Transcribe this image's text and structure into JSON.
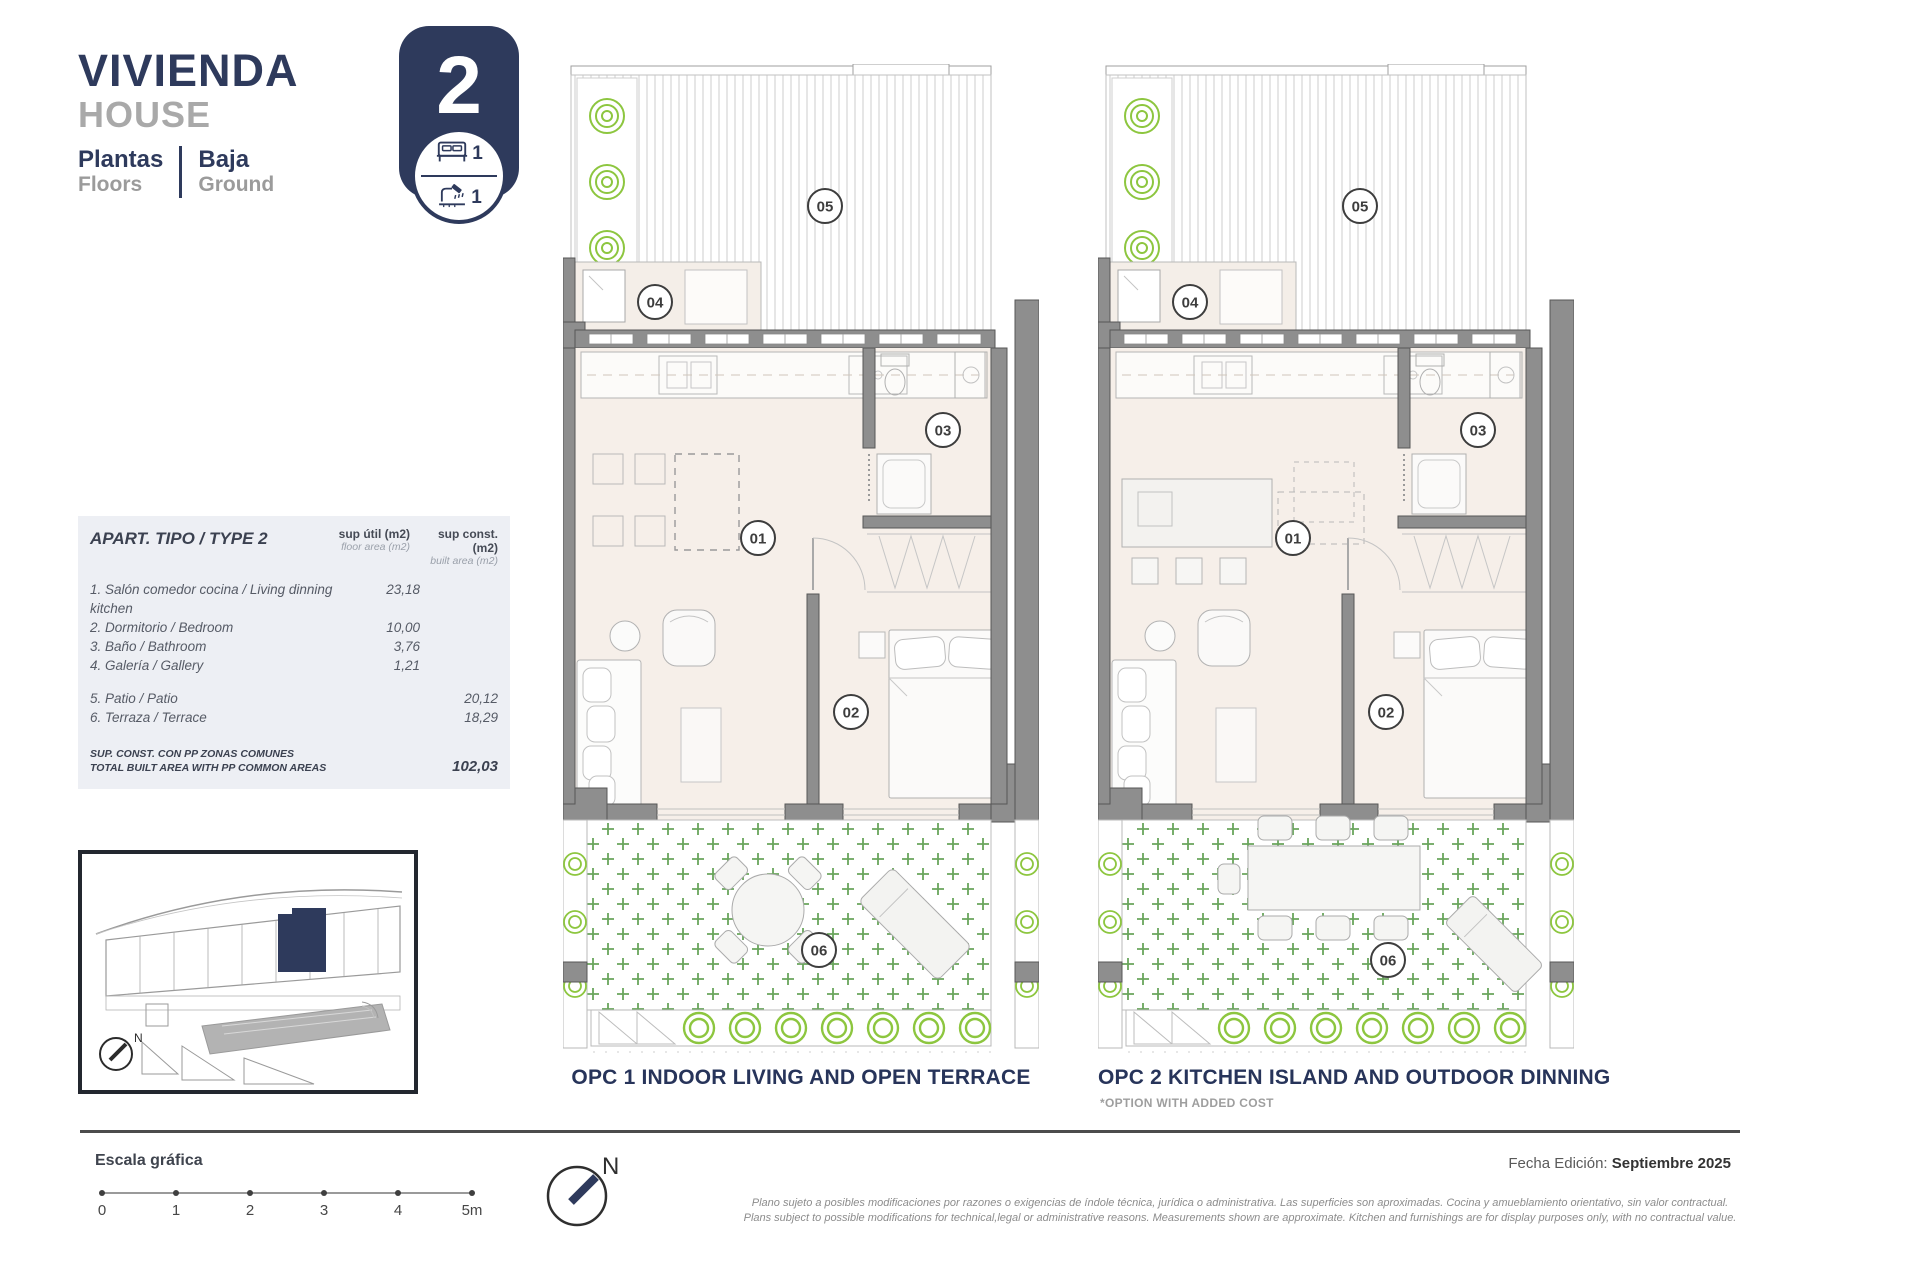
{
  "header": {
    "title_es": "VIVIENDA",
    "title_en": "HOUSE",
    "floors_es": "Plantas",
    "floors_en": "Floors",
    "level_es": "Baja",
    "level_en": "Ground"
  },
  "badge": {
    "unit_number": "2",
    "bedrooms": "1",
    "bathrooms": "1"
  },
  "areas_table": {
    "title": "APART. TIPO / TYPE 2",
    "col_util_1": "sup útil (m2)",
    "col_util_2": "floor area (m2)",
    "col_const_1": "sup const. (m2)",
    "col_const_2": "built area (m2)",
    "rows_util": [
      {
        "label": "1. Salón comedor cocina / Living dinning kitchen",
        "value": "23,18"
      },
      {
        "label": "2. Dormitorio / Bedroom",
        "value": "10,00"
      },
      {
        "label": "3. Baño / Bathroom",
        "value": "3,76"
      },
      {
        "label": "4. Galería / Gallery",
        "value": "1,21"
      }
    ],
    "rows_const": [
      {
        "label": "5. Patio / Patio",
        "value": "20,12"
      },
      {
        "label": "6. Terraza / Terrace",
        "value": "18,29"
      }
    ],
    "total_label_line1": "SUP. CONST. CON PP ZONAS COMUNES",
    "total_label_line2": "TOTAL BUILT AREA WITH PP COMMON AREAS",
    "total_value": "102,03"
  },
  "site_plan": {
    "north_label": "N"
  },
  "plans": {
    "room_labels": [
      "01",
      "02",
      "03",
      "04",
      "05",
      "06"
    ],
    "opc1_caption": "OPC 1 INDOOR LIVING AND OPEN TERRACE",
    "opc2_caption": "OPC 2 KITCHEN ISLAND AND OUTDOOR DINNING",
    "opc2_note": "*OPTION WITH ADDED COST"
  },
  "footer": {
    "scale_label": "Escala gráfica",
    "scale_ticks": [
      "0",
      "1",
      "2",
      "3",
      "4",
      "5m"
    ],
    "north_label": "N",
    "date_label": "Fecha Edición:",
    "date_value": "Septiembre 2025",
    "disclaimer_es": "Plano sujeto a posibles modificaciones por razones o exigencias de índole técnica,  jurídica o administrativa. Las superficies son aproximadas. Cocina y amueblamiento orientativo, sin valor contractual.",
    "disclaimer_en": "Plans subject to possible modifications for technical,legal or administrative reasons. Measurements shown are approximate. Kitchen and furnishings are for display purposes only, with no contractual value."
  },
  "colors": {
    "navy": "#2e3a5c",
    "wall": "#8e8e8e",
    "wall_stroke": "#575757",
    "floor": "#f6efe9",
    "green": "#8dc63f",
    "terrace_green": "#69a55c",
    "table_bg": "#edeff4"
  }
}
